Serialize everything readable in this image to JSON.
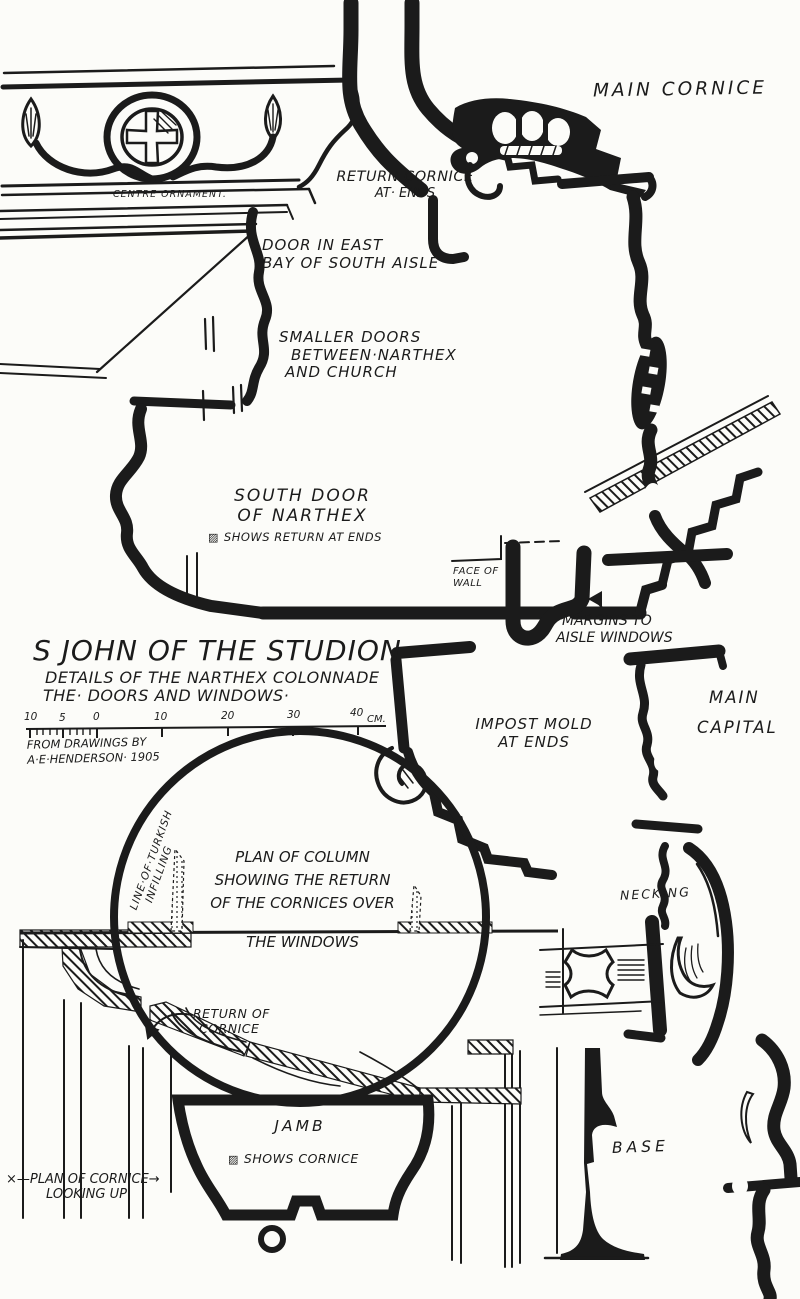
{
  "colors": {
    "ink": "#1b1b1b",
    "paper": "#fcfcf9"
  },
  "icons": {
    "hatch": "▨"
  },
  "title_block": {
    "title": "S JOHN OF THE STUDION",
    "subtitle_line1": "DETAILS OF THE NARTHEX COLONNADE",
    "subtitle_line2": "THE· DOORS AND WINDOWS·",
    "credit_line1": "FROM DRAWINGS BY",
    "credit_line2": "A·E·HENDERSON· 1905",
    "scale": {
      "labels": [
        "10",
        "5",
        "0",
        "10",
        "20",
        "30",
        "40"
      ],
      "unit": "CM."
    }
  },
  "labels": {
    "main_cornice": "MAIN CORNICE",
    "return_cornice_l1": "RETURN CORNICE",
    "return_cornice_l2": "AT· ENDS",
    "centre_ornament": "CENTRE ORNAMENT.",
    "door_east_l1": "DOOR IN EAST",
    "door_east_l2": "BAY OF SOUTH AISLE",
    "smaller_doors_l1": "SMALLER DOORS",
    "smaller_doors_l2": "BETWEEN·NARTHEX",
    "smaller_doors_l3": "AND CHURCH",
    "south_door_l1": "SOUTH DOOR",
    "south_door_l2": "OF NARTHEX",
    "south_door_note": "SHOWS RETURN AT ENDS",
    "face_of_wall_l1": "FACE OF",
    "face_of_wall_l2": "WALL",
    "margins_l1": "MARGINS TO",
    "margins_l2": "AISLE WINDOWS",
    "impost_l1": "IMPOST MOLD",
    "impost_l2": "AT ENDS",
    "main_capital_l1": "MAIN",
    "main_capital_l2": "CAPITAL",
    "plan_column_l1": "PLAN OF COLUMN",
    "plan_column_l2": "SHOWING THE RETURN",
    "plan_column_l3": "OF THE CORNICES OVER",
    "plan_column_l4": "THE WINDOWS",
    "infilling_l1": "LINE·OF·TURKISH",
    "infilling_l2": "INFILLING",
    "necking": "NECKING",
    "return_cornice_plan_l1": "RETURN OF",
    "return_cornice_plan_l2": "CORNICE",
    "jamb": "JAMB",
    "jamb_note": "SHOWS CORNICE",
    "plan_cornice_l1": "×—PLAN OF CORNICE→",
    "plan_cornice_l2": "LOOKING UP",
    "base": "BASE"
  }
}
